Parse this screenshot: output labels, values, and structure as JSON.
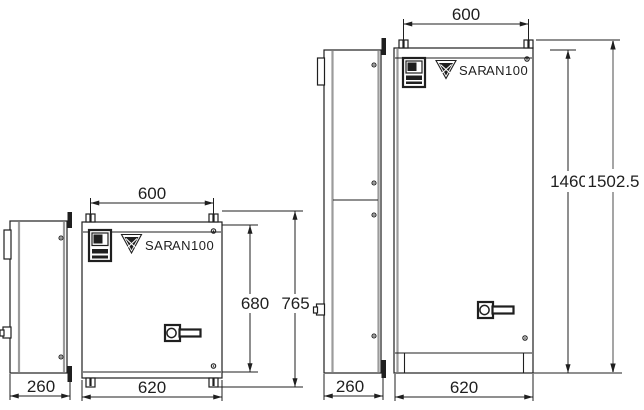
{
  "drawing": {
    "colors": {
      "line": "#1f1f1f",
      "panel": "#9b9b9b"
    },
    "small_cabinet": {
      "brand": "SAR",
      "model": "AN100",
      "dims": {
        "top_width": "600",
        "door_height": "680",
        "overall_height": "765",
        "depth": "260",
        "overall_width": "620"
      }
    },
    "large_cabinet": {
      "brand": "SAR",
      "model": "AN100",
      "dims": {
        "top_width": "600",
        "body_height": "1460",
        "overall_height": "1502.5",
        "depth": "260",
        "overall_width": "620"
      }
    }
  }
}
